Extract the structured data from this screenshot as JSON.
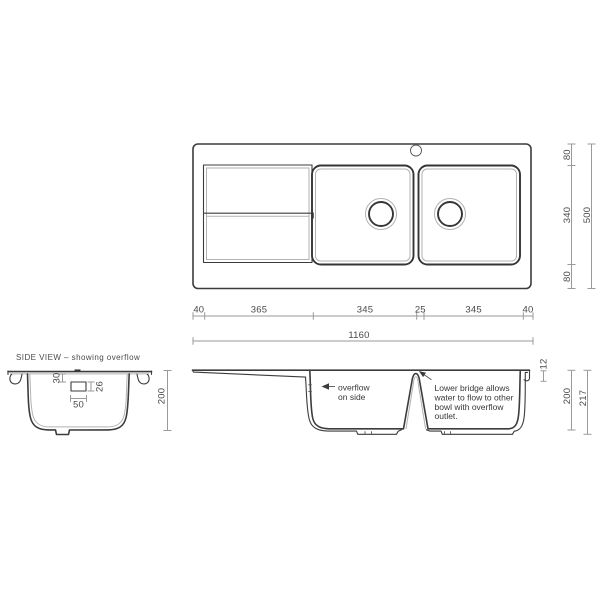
{
  "colors": {
    "outline": "#3c3c3c",
    "light_line": "#b2b2b2",
    "dimension_line": "#9a9a9a",
    "dimension_text": "#4a4a4a",
    "background": "#ffffff"
  },
  "top_view": {
    "width_dims": {
      "segments": [
        "40",
        "365",
        "345",
        "25",
        "345",
        "40"
      ],
      "total": "1160"
    },
    "height_dims": {
      "segments": [
        "80",
        "340",
        "80"
      ],
      "total": "500"
    }
  },
  "side_view": {
    "title": "SIDE VIEW – showing overflow",
    "dims": {
      "rim_to_overflow": "30",
      "overflow_height": "26",
      "overflow_width": "50",
      "bowl_depth": "200"
    }
  },
  "section_view": {
    "overflow_note": {
      "line1": "overflow",
      "line2": "on side"
    },
    "bridge_note": {
      "line1": "Lower bridge allows",
      "line2": "water to flow to other",
      "line3": "bowl with overflow",
      "line4": "outlet."
    },
    "dims": {
      "rim_height": "12",
      "bowl_depth": "200",
      "overall_depth": "217"
    }
  }
}
